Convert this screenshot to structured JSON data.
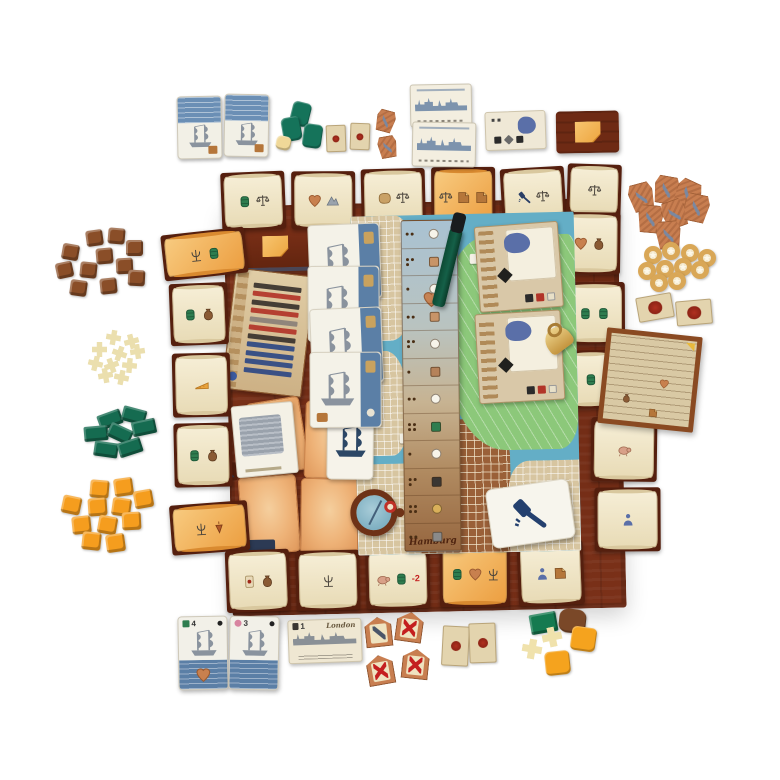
{
  "labels": {
    "board_name": "Hamburg",
    "city_card": "London",
    "london_value": "1",
    "ship1_value": "4",
    "ship2_value": "3"
  },
  "palette": {
    "board_wood": "#7b3119",
    "parchment": "#f1e7cb",
    "orange_card": "#ec9e40",
    "map_water": "#64aec6",
    "map_park": "#8cc87a",
    "navy": "#2c4766",
    "accent_red": "#c41f1f",
    "ring_gold": "#d9a757"
  },
  "board_edge_cards": [
    {
      "x": -2,
      "y": -34,
      "w": 64,
      "h": 58,
      "kind": "scroll",
      "rot": -1,
      "icons": [
        "barrel",
        "scales"
      ]
    },
    {
      "x": 68,
      "y": -33,
      "w": 64,
      "h": 58,
      "kind": "scroll",
      "rot": 1,
      "icons": [
        "heart",
        "mountain"
      ]
    },
    {
      "x": 138,
      "y": -34,
      "w": 64,
      "h": 58,
      "kind": "scroll",
      "rot": 0,
      "icons": [
        "hide",
        "scales"
      ]
    },
    {
      "x": 208,
      "y": -34,
      "w": 64,
      "h": 60,
      "kind": "orange",
      "rot": 1,
      "icons": [
        "scales",
        "note",
        "note"
      ]
    },
    {
      "x": 278,
      "y": -32,
      "w": 64,
      "h": 58,
      "kind": "scroll",
      "rot": -2,
      "icons": [
        "gavel",
        "scales"
      ]
    },
    {
      "x": 344,
      "y": -34,
      "w": 54,
      "h": 52,
      "kind": "scroll",
      "rot": 3,
      "icons": [
        "scales"
      ]
    },
    {
      "x": -62,
      "y": 24,
      "w": 84,
      "h": 46,
      "kind": "orange",
      "rot": -5,
      "icons": [
        "trident",
        "barrel"
      ]
    },
    {
      "x": -56,
      "y": 76,
      "w": 58,
      "h": 62,
      "kind": "scroll",
      "rot": -1,
      "icons": [
        "barrel",
        "sack"
      ]
    },
    {
      "x": -55,
      "y": 146,
      "w": 58,
      "h": 64,
      "kind": "scroll",
      "rot": 0,
      "icons": [
        "cheese"
      ]
    },
    {
      "x": -55,
      "y": 216,
      "w": 58,
      "h": 64,
      "kind": "scroll",
      "rot": 0,
      "icons": [
        "barrel",
        "sack"
      ]
    },
    {
      "x": -60,
      "y": 296,
      "w": 78,
      "h": 50,
      "kind": "orange",
      "rot": -3,
      "icons": [
        "trident",
        "top"
      ]
    },
    {
      "x": 334,
      "y": 14,
      "w": 62,
      "h": 62,
      "kind": "scroll",
      "rot": 2,
      "icons": [
        "heart",
        "sack"
      ]
    },
    {
      "x": 337,
      "y": 84,
      "w": 62,
      "h": 62,
      "kind": "scroll",
      "rot": 1,
      "icons": [
        "barrel",
        "barrel"
      ]
    },
    {
      "x": 340,
      "y": 152,
      "w": 46,
      "h": 58,
      "kind": "scroll",
      "rot": 0,
      "icons": [
        "barrel"
      ]
    },
    {
      "x": 362,
      "y": 220,
      "w": 66,
      "h": 64,
      "kind": "scroll",
      "rot": 2,
      "icons": [
        "pig"
      ]
    },
    {
      "x": 364,
      "y": 290,
      "w": 66,
      "h": 64,
      "kind": "scroll",
      "rot": 1,
      "icons": [
        "figure"
      ]
    },
    {
      "x": -6,
      "y": 344,
      "w": 64,
      "h": 62,
      "kind": "scroll",
      "rot": -1,
      "icons": [
        "carddot",
        "sack"
      ]
    },
    {
      "x": 64,
      "y": 346,
      "w": 64,
      "h": 60,
      "kind": "scroll",
      "rot": 0,
      "icons": [
        "trident"
      ]
    },
    {
      "x": 134,
      "y": 346,
      "w": 64,
      "h": 60,
      "kind": "scroll",
      "rot": 0,
      "icons": [
        "pig",
        "barrel"
      ],
      "text": "-2"
    },
    {
      "x": 208,
      "y": 340,
      "w": 70,
      "h": 66,
      "kind": "orange",
      "rot": 1,
      "icons": [
        "barrel",
        "heart",
        "trident"
      ]
    },
    {
      "x": 286,
      "y": 342,
      "w": 66,
      "h": 64,
      "kind": "scroll",
      "rot": -1,
      "icons": [
        "figure",
        "note"
      ]
    }
  ],
  "track": {
    "cells": [
      {
        "p": 2,
        "t": "dot",
        "c": "#f7f4ea"
      },
      {
        "p": 3,
        "t": "sq",
        "c": "#c89468"
      },
      {
        "p": 1,
        "t": "dot",
        "c": "#f7f4ea"
      },
      {
        "p": 2,
        "t": "sq",
        "c": "#c89468"
      },
      {
        "p": 3,
        "t": "dot",
        "c": "#f7f4ea"
      },
      {
        "p": 1,
        "t": "sq",
        "c": "#b5825a"
      },
      {
        "p": 2,
        "t": "dot",
        "c": "#f7f4ea"
      },
      {
        "p": 4,
        "t": "sq",
        "c": "#2e7d4f"
      },
      {
        "p": 1,
        "t": "dot",
        "c": "#f7f4ea"
      },
      {
        "p": 3,
        "t": "sq",
        "c": "#3a3632"
      },
      {
        "p": 4,
        "t": "dot",
        "c": "#d9b05a"
      },
      {
        "p": 2,
        "t": "sq",
        "c": "#8a8a8a"
      }
    ]
  },
  "chart": {
    "bars": [
      "#38322c",
      "#b23428",
      "#38322c",
      "#b23428",
      "#8a8078",
      "#b23428",
      "#38322c",
      "#2c4884",
      "#2c4884",
      "#2c4884",
      "#2c4884"
    ]
  },
  "clusters": {
    "brown_cubes": {
      "shape": "cube",
      "w": 17,
      "h": 16,
      "color": "#8a4e28",
      "items": [
        [
          86,
          230,
          -8
        ],
        [
          108,
          228,
          5
        ],
        [
          62,
          244,
          10
        ],
        [
          96,
          248,
          -5
        ],
        [
          126,
          240,
          0
        ],
        [
          56,
          262,
          -12
        ],
        [
          80,
          262,
          6
        ],
        [
          116,
          258,
          -3
        ],
        [
          70,
          280,
          8
        ],
        [
          100,
          278,
          -6
        ],
        [
          128,
          270,
          3
        ]
      ]
    },
    "cream_tokens": {
      "shape": "cross",
      "w": 15,
      "h": 15,
      "color": "#ebdfae",
      "items": [
        [
          106,
          330,
          10
        ],
        [
          124,
          334,
          -15
        ],
        [
          92,
          342,
          0
        ],
        [
          112,
          346,
          20
        ],
        [
          130,
          344,
          -8
        ],
        [
          88,
          356,
          14
        ],
        [
          104,
          358,
          -20
        ],
        [
          122,
          358,
          5
        ],
        [
          98,
          368,
          -10
        ],
        [
          114,
          370,
          12
        ]
      ]
    },
    "green_blocks": {
      "shape": "brick",
      "w": 24,
      "h": 15,
      "color": "#156b50",
      "items": [
        [
          98,
          412,
          -20
        ],
        [
          122,
          408,
          15
        ],
        [
          84,
          426,
          -5
        ],
        [
          108,
          426,
          25
        ],
        [
          132,
          420,
          -12
        ],
        [
          94,
          442,
          8
        ],
        [
          118,
          440,
          -18
        ]
      ]
    },
    "orange_cubes": {
      "shape": "cube",
      "w": 19,
      "h": 18,
      "color": "#f59d1e",
      "items": [
        [
          90,
          480,
          5
        ],
        [
          114,
          478,
          -8
        ],
        [
          62,
          496,
          12
        ],
        [
          88,
          498,
          -4
        ],
        [
          112,
          498,
          8
        ],
        [
          134,
          490,
          -10
        ],
        [
          72,
          516,
          -6
        ],
        [
          98,
          516,
          10
        ],
        [
          122,
          512,
          -3
        ],
        [
          82,
          532,
          6
        ],
        [
          106,
          534,
          -8
        ]
      ]
    },
    "green_pads_top": {
      "shape": "pad",
      "w": 19,
      "h": 24,
      "color": "#15735a",
      "items": [
        [
          291,
          102,
          14
        ],
        [
          282,
          117,
          -10
        ],
        [
          303,
          124,
          8
        ]
      ]
    },
    "cream_pad_top": {
      "shape": "pad",
      "w": 15,
      "h": 14,
      "color": "#f0d898",
      "items": [
        [
          276,
          136,
          12
        ]
      ]
    },
    "dot_tiles_top": {
      "shape": "seal",
      "w": 20,
      "h": 27,
      "items": [
        [
          326,
          125,
          -2
        ],
        [
          350,
          123,
          2
        ]
      ]
    },
    "mini_pretzels_top": {
      "shape": "pretzel",
      "w": 19,
      "h": 22,
      "items": [
        [
          376,
          110,
          15
        ],
        [
          378,
          136,
          -10
        ]
      ]
    },
    "pretzels_right": {
      "shape": "pretzel",
      "w": 25,
      "h": 28,
      "items": [
        [
          629,
          183,
          -15
        ],
        [
          654,
          176,
          10
        ],
        [
          675,
          180,
          25
        ],
        [
          638,
          205,
          5
        ],
        [
          662,
          200,
          -20
        ],
        [
          684,
          194,
          12
        ],
        [
          656,
          221,
          -5
        ]
      ]
    },
    "rings_right": {
      "shape": "ring",
      "w": 18,
      "h": 18,
      "items": [
        [
          644,
          246,
          0
        ],
        [
          662,
          242,
          0
        ],
        [
          681,
          244,
          0
        ],
        [
          698,
          249,
          0
        ],
        [
          638,
          262,
          0
        ],
        [
          656,
          260,
          0
        ],
        [
          674,
          258,
          0
        ],
        [
          691,
          261,
          0
        ],
        [
          650,
          274,
          0
        ],
        [
          668,
          272,
          0
        ]
      ]
    },
    "seal_tiles_right": {
      "shape": "seal",
      "w": 36,
      "h": 25,
      "items": [
        [
          637,
          295,
          -10
        ],
        [
          676,
          300,
          -5
        ]
      ]
    },
    "dot_tiles_bottom": {
      "shape": "seal",
      "w": 27,
      "h": 40,
      "items": [
        [
          442,
          626,
          3
        ],
        [
          469,
          623,
          -2
        ]
      ]
    },
    "house_tools": {
      "shape": "house-t",
      "w": 27,
      "h": 30,
      "items": [
        [
          365,
          617,
          -6
        ]
      ]
    },
    "house_x": {
      "shape": "house-x",
      "w": 27,
      "h": 30,
      "items": [
        [
          396,
          612,
          8
        ],
        [
          367,
          655,
          -10
        ],
        [
          402,
          649,
          6
        ]
      ]
    },
    "br_green": {
      "shape": "brick",
      "w": 27,
      "h": 20,
      "color": "#157a50",
      "items": [
        [
          530,
          613,
          -10
        ]
      ]
    },
    "br_brown": {
      "shape": "blob",
      "w": 27,
      "h": 24,
      "color": "#7a4828",
      "items": [
        [
          559,
          609,
          6
        ]
      ]
    },
    "br_cream": {
      "shape": "cross",
      "w": 20,
      "h": 20,
      "color": "#f0e2ac",
      "items": [
        [
          542,
          627,
          -12
        ],
        [
          522,
          639,
          10
        ]
      ]
    },
    "br_orange": {
      "shape": "pad",
      "w": 25,
      "h": 24,
      "color": "#f5a31e",
      "items": [
        [
          571,
          627,
          8
        ],
        [
          545,
          651,
          -6
        ]
      ]
    }
  }
}
